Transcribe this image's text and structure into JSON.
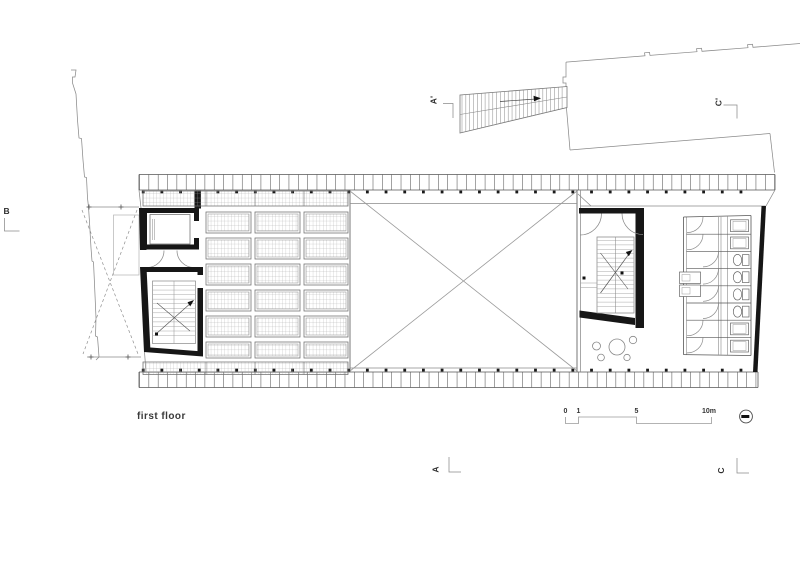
{
  "drawing": {
    "floor_label": "first floor",
    "markers": {
      "b": "B",
      "a_top": "A'",
      "c_top": "C'",
      "a_bottom": "A",
      "c_bottom": "C"
    },
    "scale_bar": {
      "ticks": [
        "0",
        "1",
        "5",
        "10m"
      ]
    },
    "north_icon": "north-indicator",
    "colors": {
      "background": "#ffffff",
      "line_dark": "#1a1a1a",
      "line_mid": "#555555",
      "line_light": "#9a9a9a",
      "wall_fill": "#161616",
      "grid_line": "#a8a8a8",
      "text": "#3a3a3a"
    }
  }
}
